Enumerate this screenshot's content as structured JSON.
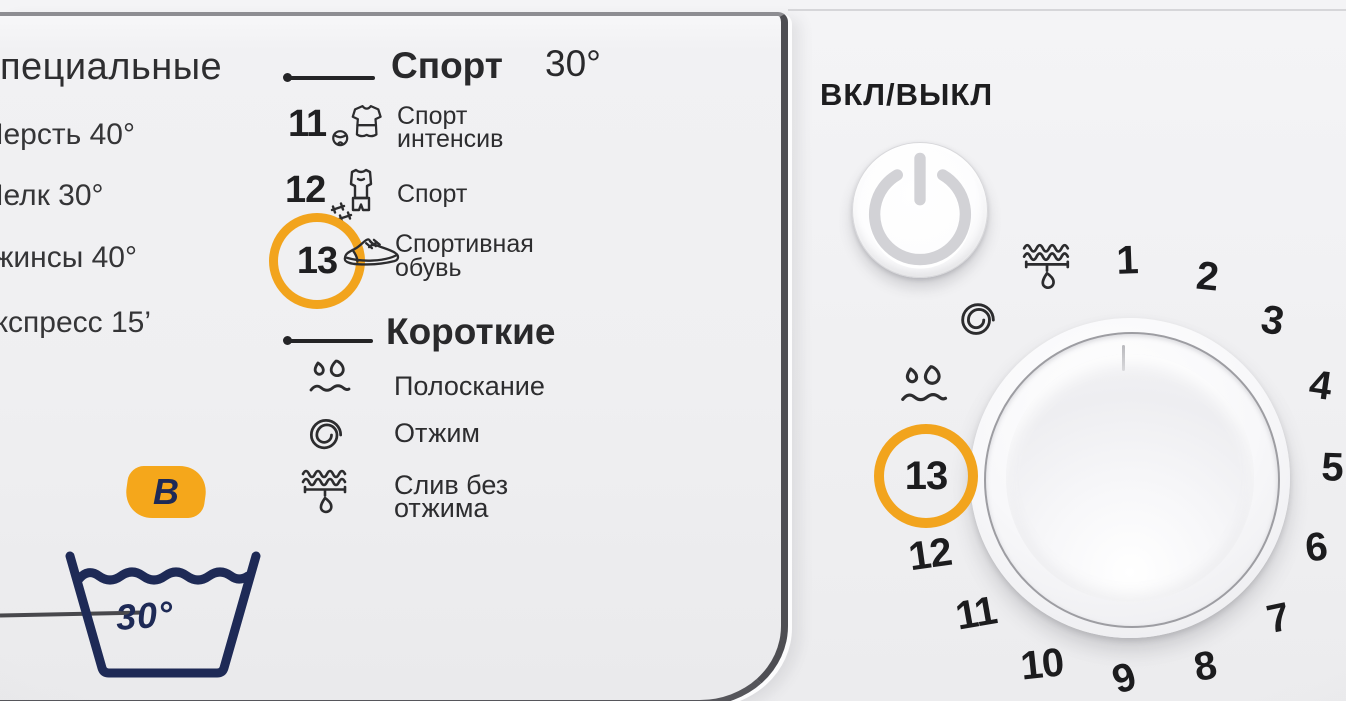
{
  "left_panel": {
    "specials": {
      "heading": "Специальные",
      "items": [
        "Шерсть 40°",
        "Шелк 30°",
        "Джинсы 40°",
        "Экспресс 15’"
      ]
    },
    "sport": {
      "title": "Спорт",
      "temperature": "30°",
      "programs": [
        {
          "number": "11",
          "icon": "sport-intensive-icon",
          "label_lines": [
            "Спорт",
            "интенсив"
          ],
          "highlighted": false
        },
        {
          "number": "12",
          "icon": "sport-icon",
          "label_lines": [
            "Спорт",
            ""
          ],
          "highlighted": false
        },
        {
          "number": "13",
          "icon": "sneakers-icon",
          "label_lines": [
            "Спортивная",
            "обувь"
          ],
          "highlighted": true
        }
      ]
    },
    "short": {
      "title": "Короткие",
      "programs": [
        {
          "icon": "rinse-icon",
          "label_lines": [
            "Полоскание",
            ""
          ]
        },
        {
          "icon": "spin-icon",
          "label_lines": [
            "Отжим",
            ""
          ]
        },
        {
          "icon": "drain-icon",
          "label_lines": [
            "Слив без",
            "отжима"
          ]
        }
      ]
    },
    "care_label": {
      "badge_letter": "В",
      "wash_temperature": "30°"
    }
  },
  "right_panel": {
    "power_label": "ВКЛ/ВЫКЛ",
    "dial": {
      "highlighted_position": "13",
      "positions": [
        {
          "value": "1",
          "x": 1127,
          "y": 261,
          "rot": -2
        },
        {
          "value": "2",
          "x": 1207,
          "y": 277,
          "rot": 6
        },
        {
          "value": "3",
          "x": 1272,
          "y": 321,
          "rot": 10
        },
        {
          "value": "4",
          "x": 1320,
          "y": 386,
          "rot": 8
        },
        {
          "value": "5",
          "x": 1332,
          "y": 468,
          "rot": 2
        },
        {
          "value": "6",
          "x": 1316,
          "y": 548,
          "rot": -6
        },
        {
          "value": "7",
          "x": 1278,
          "y": 619,
          "rot": -12
        },
        {
          "value": "8",
          "x": 1205,
          "y": 667,
          "rot": -10
        },
        {
          "value": "9",
          "x": 1124,
          "y": 679,
          "rot": -18
        },
        {
          "value": "10",
          "x": 1042,
          "y": 665,
          "rot": -6
        },
        {
          "value": "11",
          "x": 976,
          "y": 614,
          "rot": -10
        },
        {
          "value": "12",
          "x": 930,
          "y": 555,
          "rot": -8
        }
      ],
      "icons": [
        {
          "icon": "rinse-icon",
          "x": 923,
          "y": 387,
          "w": 54,
          "h": 50
        },
        {
          "icon": "spin-icon",
          "x": 978,
          "y": 320,
          "w": 46,
          "h": 48
        },
        {
          "icon": "drain-icon",
          "x": 1047,
          "y": 267,
          "w": 56,
          "h": 54
        }
      ]
    }
  },
  "colors": {
    "accent_orange": "#F2A41D",
    "navy_blue": "#1E2A56",
    "panel_gray": "#F0F0F2"
  }
}
